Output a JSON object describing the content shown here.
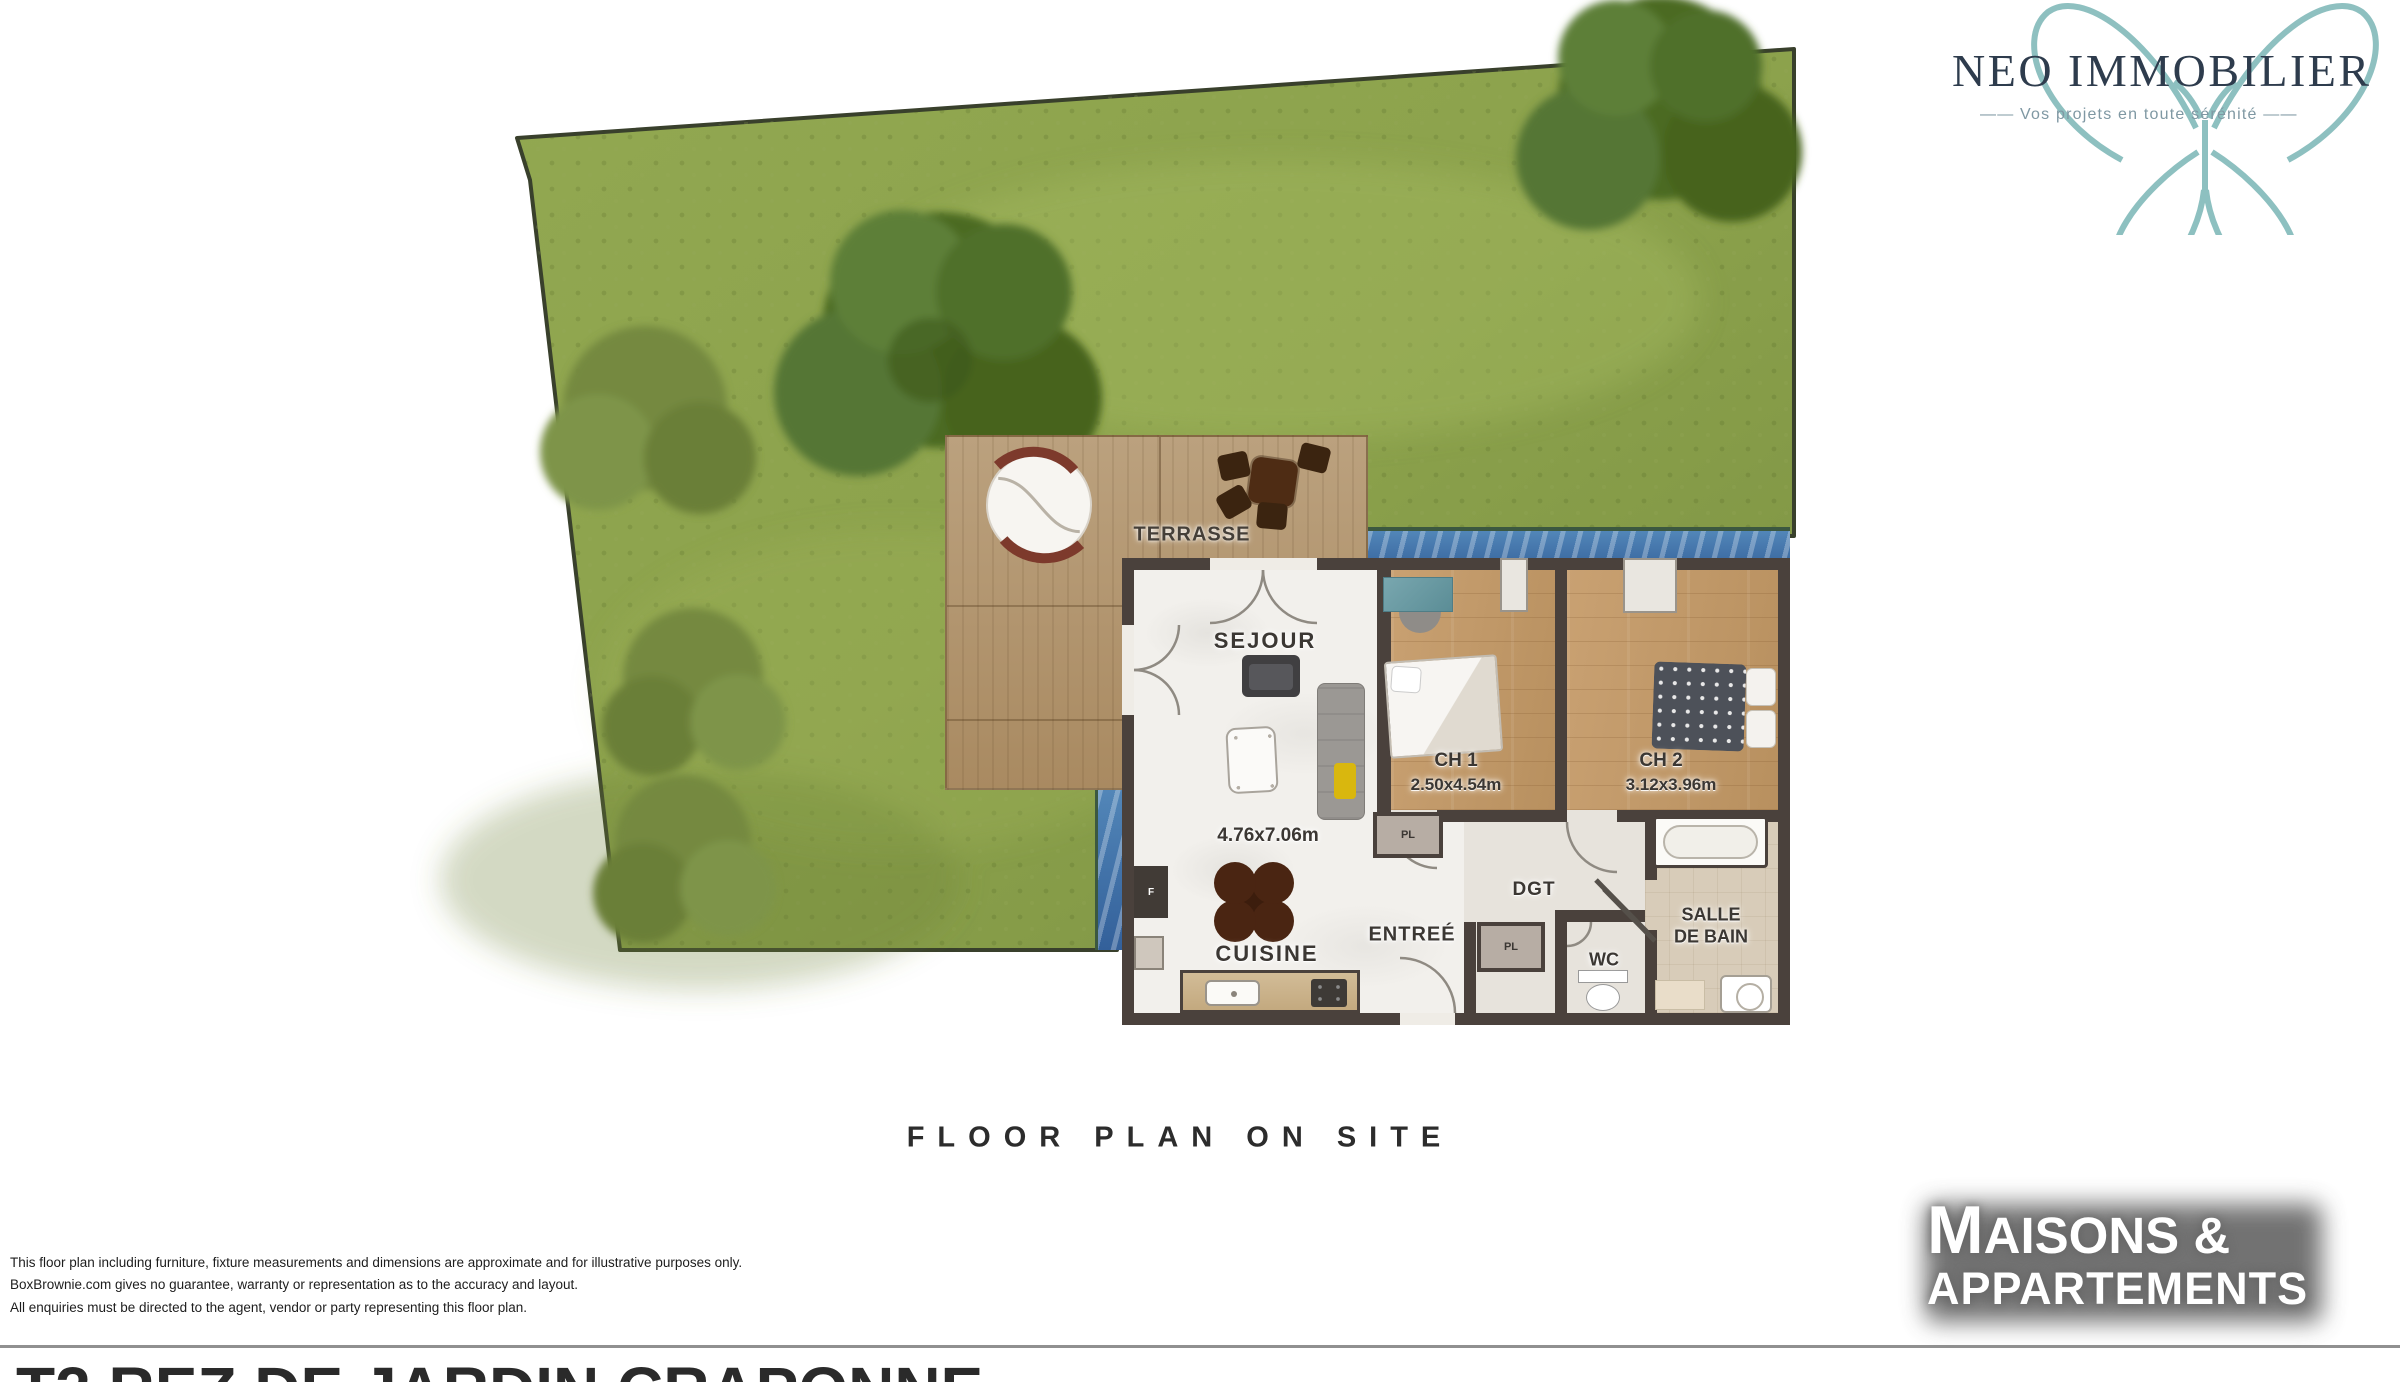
{
  "branding": {
    "neo_immobilier": {
      "name": "NEO IMMOBILIER",
      "tagline": "——  Vos projets en toute sérénité  ——",
      "butterfly_color": "#7ab5b5",
      "name_color": "#2e3c4d",
      "tagline_color": "#7f98a3"
    },
    "maisons_appartements": {
      "line1_initial": "M",
      "line1_rest": "AISONS &",
      "line2": "APPARTEMENTS",
      "text_color": "#ffffff",
      "shadow_color": "#5a5a5a"
    }
  },
  "caption": {
    "title": "FLOOR PLAN ON SITE"
  },
  "property": {
    "headline": "T2 REZ DE JARDIN CRAPONNE"
  },
  "disclaimer": {
    "line1": "This floor plan including furniture, fixture measurements and dimensions are approximate and for illustrative purposes only.",
    "line2": "BoxBrownie.com gives no guarantee, warranty or representation as to the accuracy and layout.",
    "line3": "All enquiries must be directed to the agent, vendor or party representing this floor plan."
  },
  "floor_plan": {
    "rooms": {
      "terrasse": {
        "label": "TERRASSE"
      },
      "sejour": {
        "label": "SEJOUR",
        "dimensions": "4.76x7.06m"
      },
      "cuisine": {
        "label": "CUISINE"
      },
      "entree": {
        "label": "ENTREÉ"
      },
      "dgt": {
        "label": "DGT"
      },
      "wc": {
        "label": "WC"
      },
      "salle_de_bain": {
        "label_line1": "SALLE",
        "label_line2": "DE BAIN"
      },
      "ch1": {
        "label": "CH 1",
        "dimensions": "2.50x4.54m"
      },
      "ch2": {
        "label": "CH 2",
        "dimensions": "3.12x3.96m"
      },
      "closet1": {
        "label": "PL"
      },
      "closet2": {
        "label": "PL"
      },
      "fridge": {
        "label": "F"
      }
    },
    "colors": {
      "grass": "#8ca24c",
      "deck": "#b2946e",
      "pool": "#3f72ab",
      "wall": "#4a413c",
      "wood_floor": "#c59d6d"
    }
  }
}
